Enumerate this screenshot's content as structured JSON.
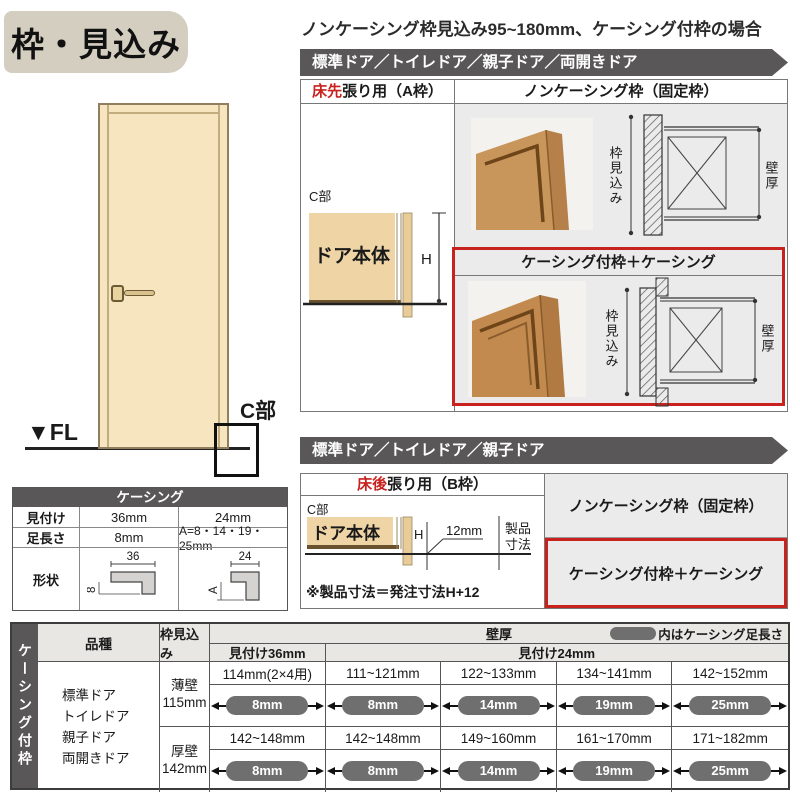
{
  "title": "枠・見込み",
  "intro": "ノンケーシング枠見込み95~180mm、ケーシング付枠の場合",
  "band_a": "標準ドア／トイレドア／親子ドア／両開きドア",
  "band_b": "標準ドア／トイレドア／親子ドア",
  "door_figure": {
    "fl": "▼FL",
    "c_label": "C部"
  },
  "frame_a": {
    "head_left_red": "床先",
    "head_left_rest": "張り用（A枠）",
    "head_right": "ノンケーシング枠（固定枠）",
    "c_label": "C部",
    "door_body": "ドア本体",
    "h_label": "H",
    "casing_header": "ケーシング付枠＋ケーシング",
    "dim_depth": "枠見込み",
    "dim_wall": "壁厚"
  },
  "frame_b": {
    "head_left_red": "床後",
    "head_left_rest": "張り用（B枠）",
    "c_label": "C部",
    "door_body": "ドア本体",
    "h_label": "H",
    "dim_12": "12mm",
    "product_line1": "製品",
    "product_line2": "寸法",
    "note": "※製品寸法＝発注寸法H+12",
    "cell_noncasing": "ノンケーシング枠（固定枠）",
    "cell_casing": "ケーシング付枠＋ケーシング"
  },
  "casing_table": {
    "title": "ケーシング",
    "row1_label": "見付け",
    "row1_col1": "36mm",
    "row1_col2": "24mm",
    "row2_label": "足長さ",
    "row2_col1": "8mm",
    "row2_col2": "A=8・14・19・25mm",
    "row3_label": "形状",
    "shape36_width": "36",
    "shape36_foot": "8",
    "shape24_width": "24",
    "shape24_foot": "A"
  },
  "spec_table": {
    "side": "ケーシング付枠",
    "h_kind": "品種",
    "h_depth": "枠見込み",
    "h_wall": "壁厚",
    "legend": "内はケーシング足長さ",
    "h_m36": "見付け36mm",
    "h_m24": "見付け24mm",
    "kind1": "標準ドア",
    "kind2": "トイレドア",
    "kind3": "親子ドア",
    "kind4": "両開きドア",
    "rows": [
      {
        "wall": "薄壁",
        "depth": "115mm",
        "c1": "114mm(2×4用)",
        "p1": "8mm",
        "c2": "111~121mm",
        "p2": "8mm",
        "c3": "122~133mm",
        "p3": "14mm",
        "c4": "134~141mm",
        "p4": "19mm",
        "c5": "142~152mm",
        "p5": "25mm"
      },
      {
        "wall": "厚壁",
        "depth": "142mm",
        "c1": "142~148mm",
        "p1": "8mm",
        "c2": "142~148mm",
        "p2": "8mm",
        "c3": "149~160mm",
        "p3": "14mm",
        "c4": "161~170mm",
        "p4": "19mm",
        "c5": "171~182mm",
        "p5": "25mm"
      }
    ]
  },
  "colors": {
    "accent_red": "#c8221f",
    "bar_gray": "#595757",
    "door_tan": "#f4e2ba",
    "panel_gray": "#ebebeb",
    "pill_gray": "#6f6f6f",
    "badge_beige": "#d4cec0"
  }
}
